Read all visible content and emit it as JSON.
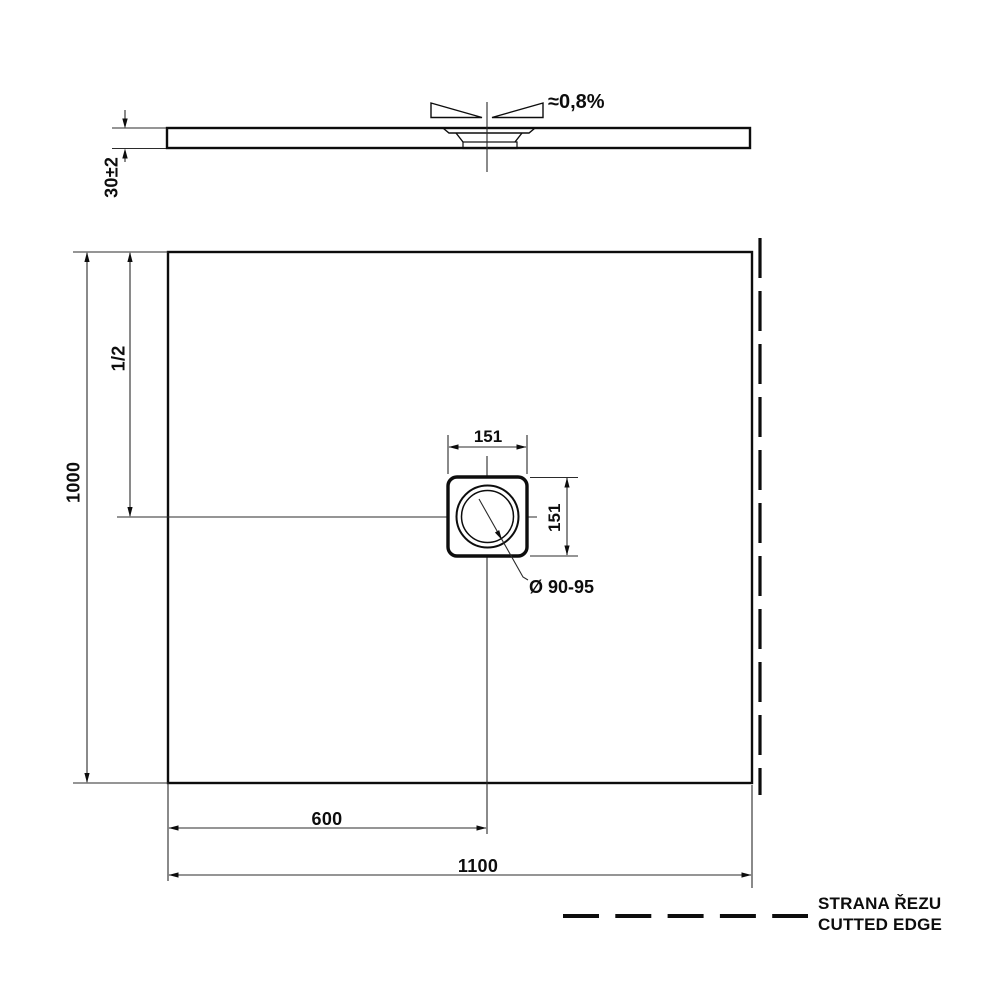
{
  "drawing": {
    "type": "shower-tray technical drawing, side profile and plan view",
    "side_view": {
      "thickness_label": "30±2",
      "slope_label": "≈0,8%"
    },
    "plan_view": {
      "height_label": "1000",
      "half_height_label": "1/2",
      "drain_width_label": "151",
      "drain_height_label": "151",
      "drain_diameter_label": "Ø 90-95",
      "drain_offset_label": "600",
      "width_label": "1100"
    },
    "legend": {
      "cut_edge_cs": "STRANA ŘEZU",
      "cut_edge_en": "CUTTED EDGE"
    },
    "colors": {
      "line": "#0d0d0d",
      "thin_line": "#2b2b2b",
      "background": "#ffffff"
    }
  }
}
